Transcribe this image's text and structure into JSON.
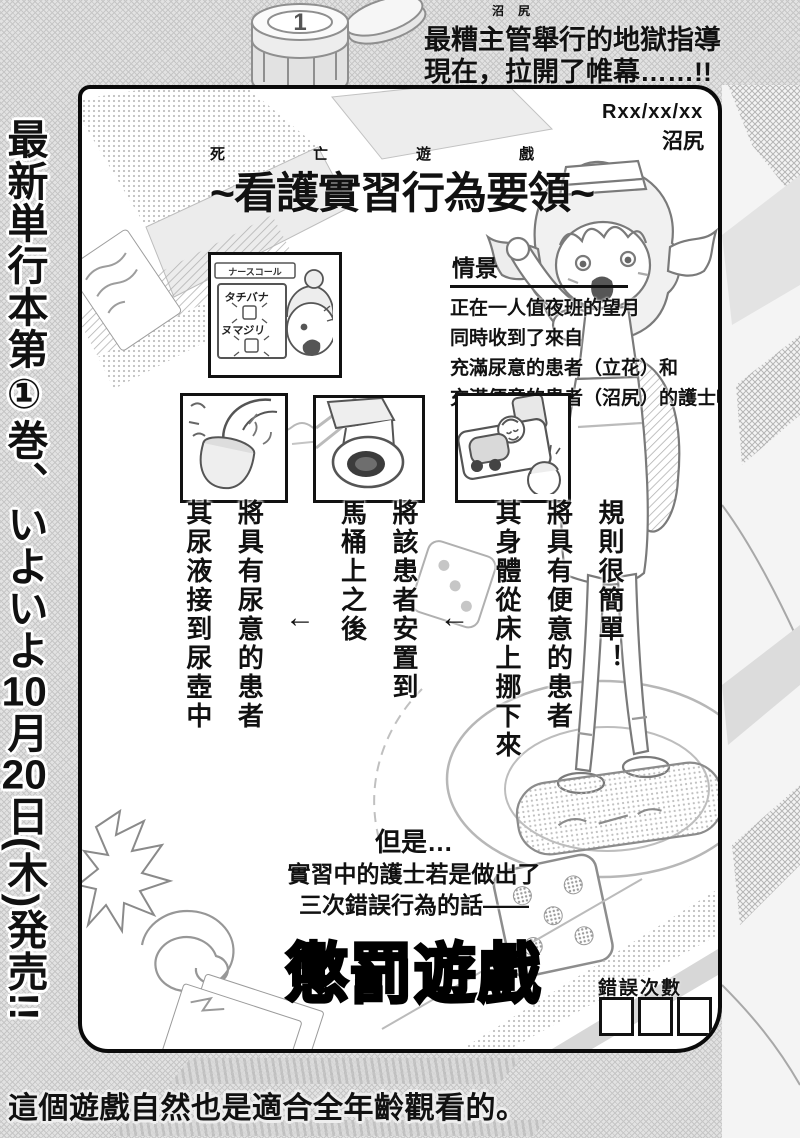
{
  "top_banner": {
    "furigana": "沼尻",
    "line1": "最糟主管舉行的地獄指導",
    "line2": "現在，拉開了帷幕……!!",
    "chip_label": "1"
  },
  "left_banner": {
    "part1": "最新単行本第①巻、いよいよ",
    "num1": "10",
    "part2": "月",
    "num2": "20",
    "part3": "日(木)発売!!"
  },
  "bottom_banner": {
    "text": "這個遊戲自然也是適合全年齡觀看的。"
  },
  "panel": {
    "date": "Rxx/xx/xx",
    "signature": "沼尻",
    "title": {
      "furigana": "死亡遊戲",
      "text": "~看護實習行為要領~"
    },
    "scenario": {
      "heading": "情景",
      "line1": "正在一人值夜班的望月",
      "line2": "同時收到了來自",
      "line3": "充滿尿意的患者（立花）和",
      "line4": "充滿便意的患者（沼尻）的護士呼叫鈴…",
      "inset": {
        "sign": "ナースコール",
        "name1": "タチバナ",
        "name2": "ヌマジリ"
      }
    },
    "rules": {
      "intro": "規則很簡單！",
      "arrow": "←",
      "step1a": "將具有便意的患者",
      "step1b": "其身體從床上挪下來",
      "step2a": "將該患者安置到",
      "step2b": "馬桶上之後",
      "step3a": "將具有尿意的患者",
      "step3b": "其尿液接到尿壺中"
    },
    "penalty": {
      "but": "但是…",
      "cond1": "實習中的護士若是做出了",
      "cond2": "三次錯誤行為的話——",
      "title": "懲罰遊戲"
    },
    "mistakes": {
      "label": "錯誤次數"
    }
  }
}
